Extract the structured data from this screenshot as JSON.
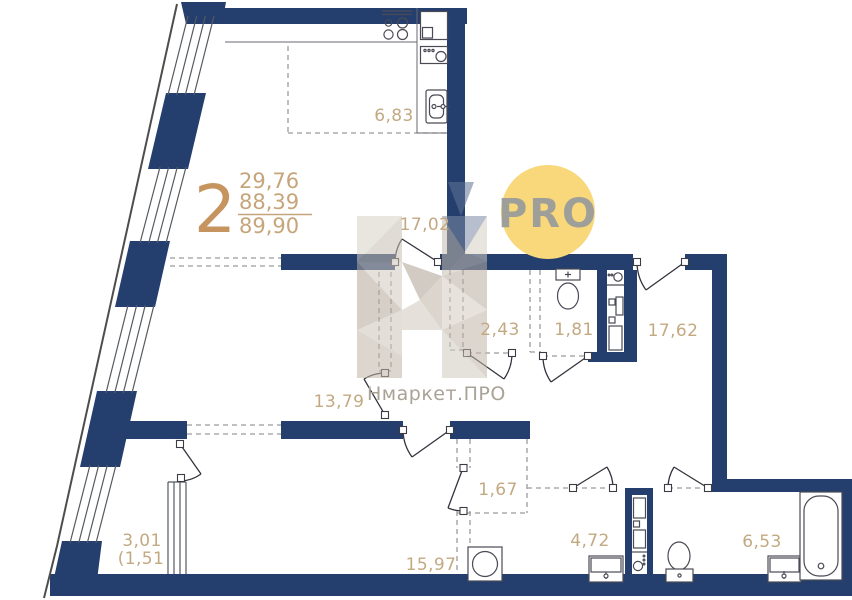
{
  "meta": {
    "brand": "Нмаркет.ПРО",
    "badge": "PRO"
  },
  "unit": {
    "rooms_count": "2",
    "area_living": "29,76",
    "area_no_balcony": "88,39",
    "area_total": "89,90"
  },
  "rooms": {
    "kitchen_living": "17,02",
    "kitchen_zone": "6,83",
    "living": "13,79",
    "hallway": "17,62",
    "wardrobe": "2,43",
    "wc": "1,81",
    "closet": "1,67",
    "bedroom": "15,97",
    "bathroom": "4,72",
    "bathroom_big": "6,53",
    "balcony": "3,01",
    "balcony_coeff": "(1,51"
  },
  "colors": {
    "wall": "#243f6e",
    "label": "#c3a982",
    "unit_accent": "#c6945f",
    "badge_bg": "#f8d87b",
    "badge_text": "#9f9f9a",
    "watermark_text": "#a9a296"
  }
}
